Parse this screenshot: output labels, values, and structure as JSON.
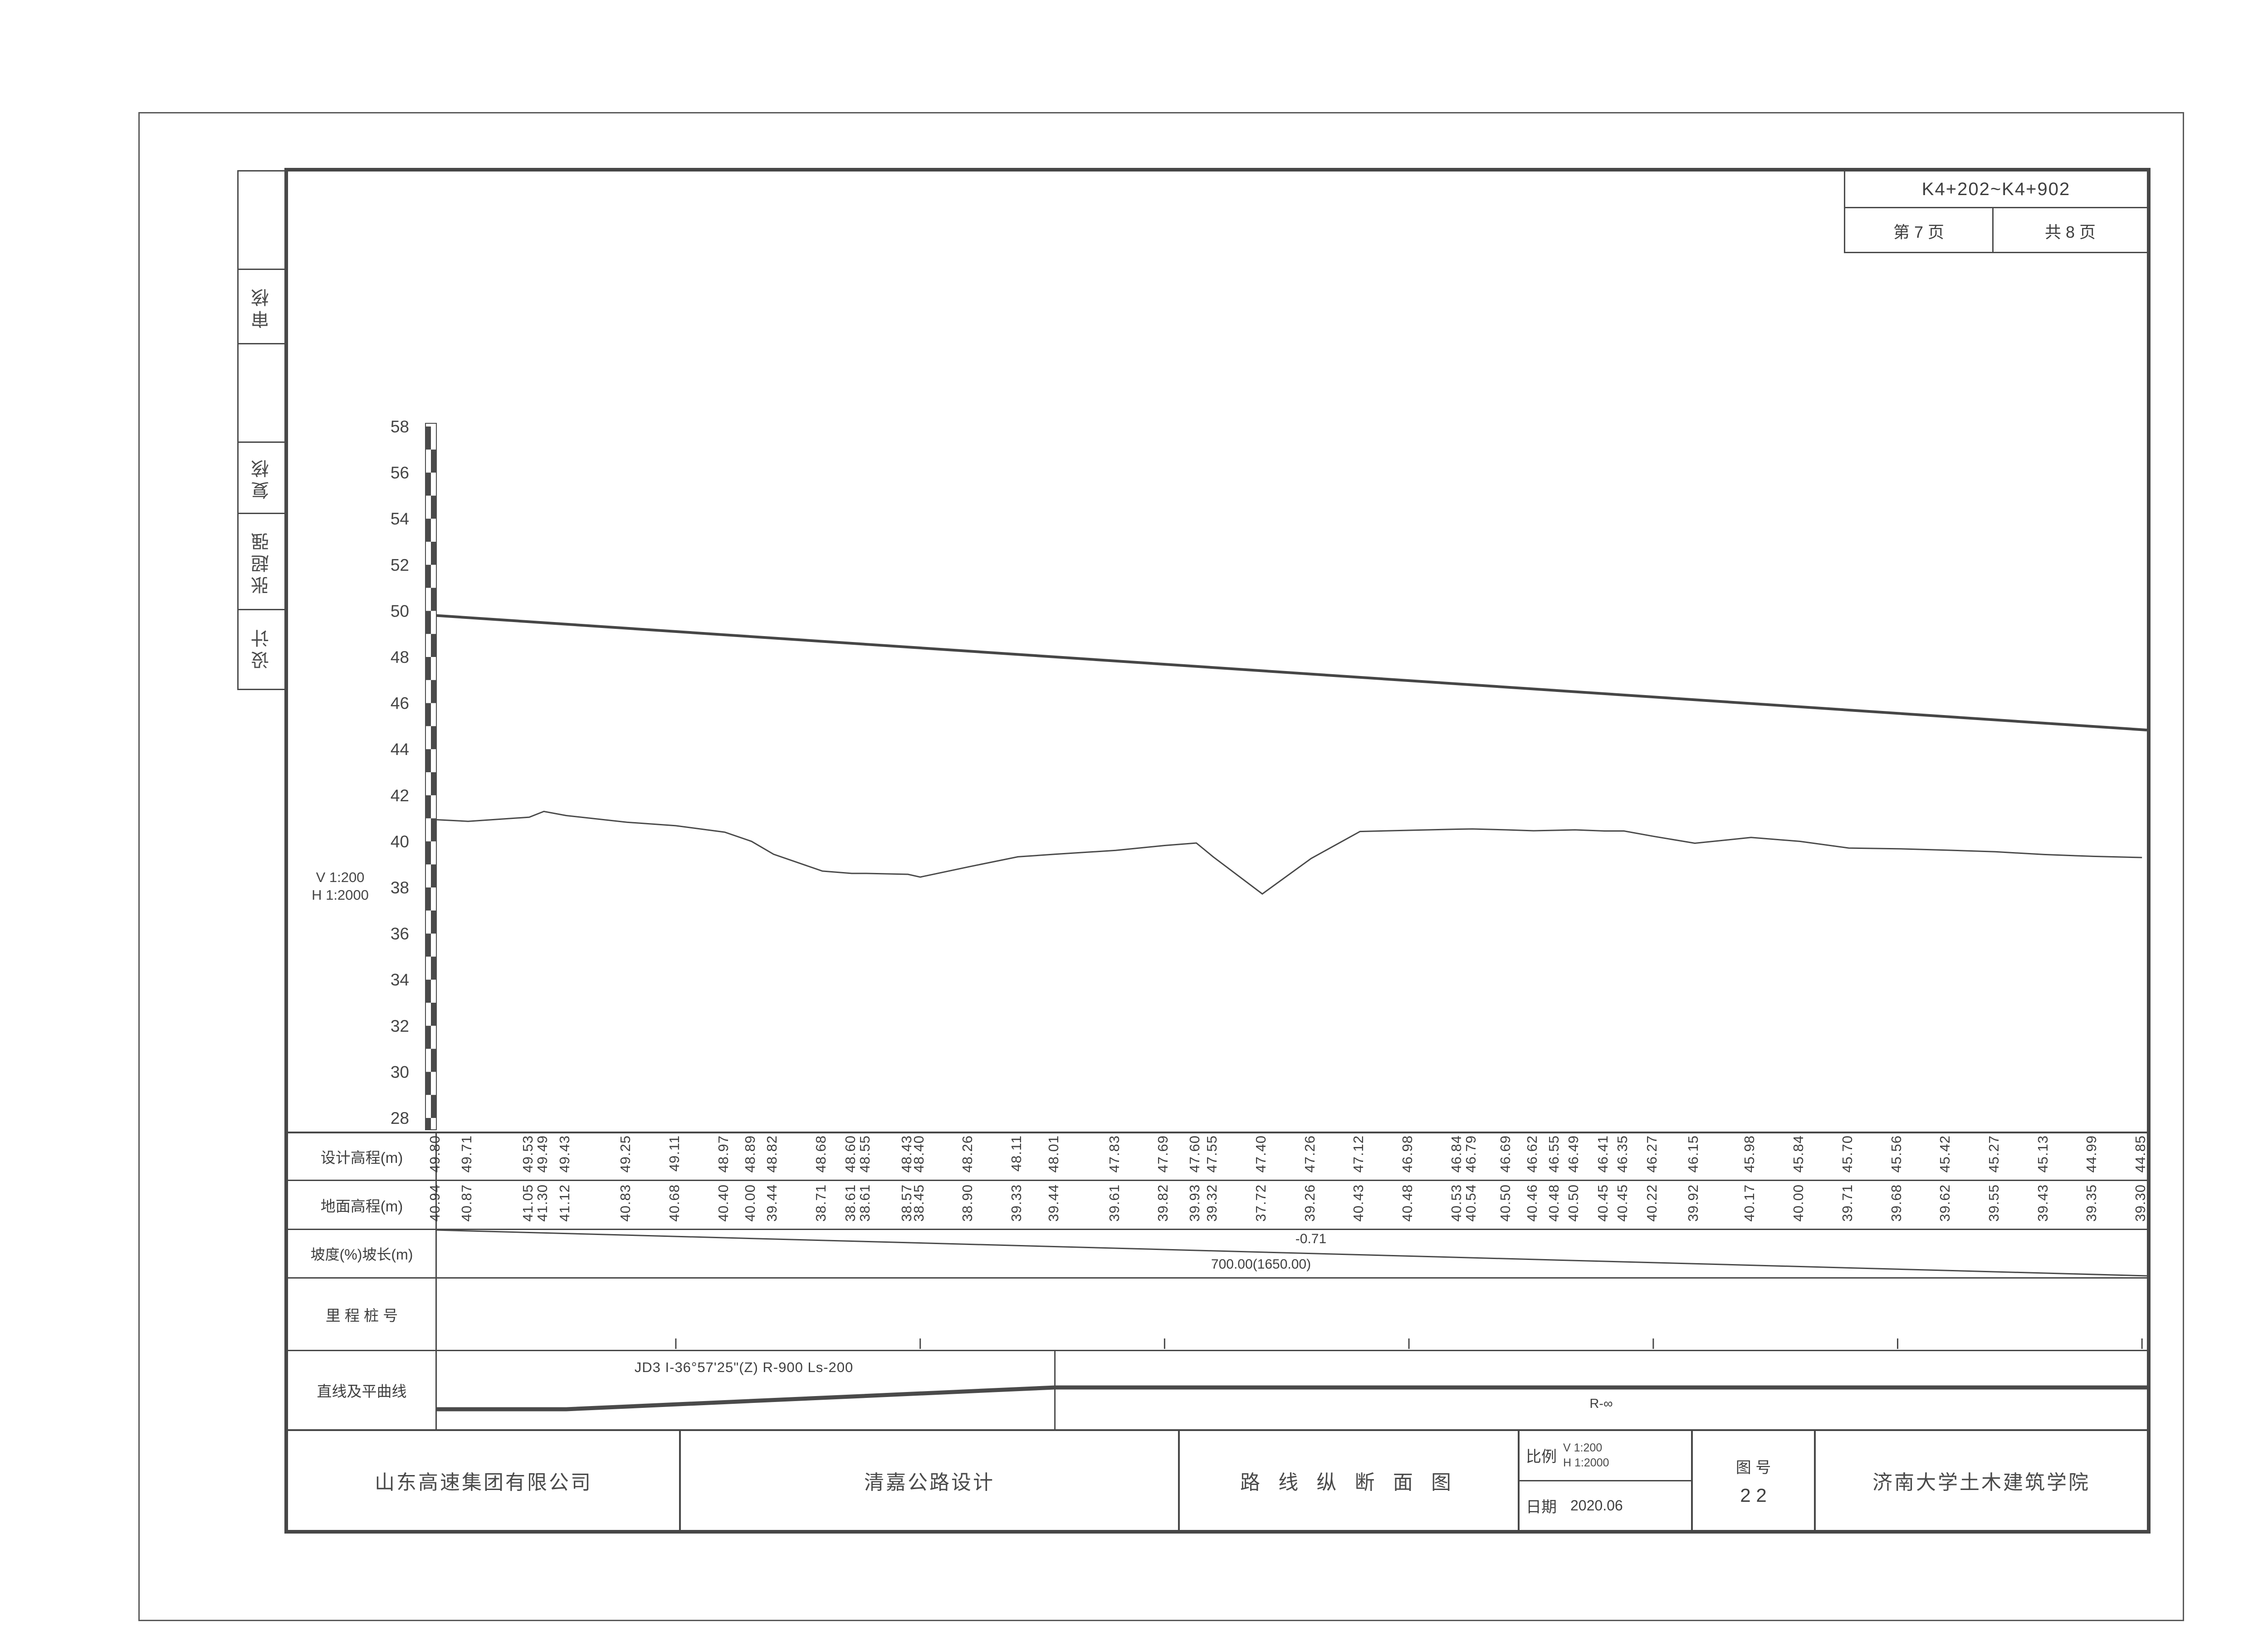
{
  "header": {
    "range": "K4+202~K4+902",
    "page_label": "第  7  页",
    "total_label": "共  8  页"
  },
  "sidebar": {
    "items": [
      {
        "label": ""
      },
      {
        "label": "审核"
      },
      {
        "label": ""
      },
      {
        "label": "复核"
      },
      {
        "label": "张超强"
      },
      {
        "label": "设计"
      }
    ]
  },
  "scale_note": {
    "v": "V 1:200",
    "h": "H 1:2000"
  },
  "axis": {
    "min": 28,
    "max": 58,
    "step": 2,
    "unit": "m"
  },
  "table": {
    "row_labels": [
      "设计高程(m)",
      "地面高程(m)",
      "坡度(%)坡长(m)",
      "里 程 桩 号",
      "直线及平曲线"
    ]
  },
  "slope": {
    "grade": "-0.71",
    "length": "700.00(1650.00)"
  },
  "curve": {
    "left_label": "JD3 I-36°57'25\"(Z) R-900 Ls-200",
    "right_label": "R-∞"
  },
  "title_block": {
    "company": "山东高速集团有限公司",
    "project": "清嘉公路设计",
    "drawing_title": "路 线 纵 断 面 图",
    "scale_label": "比例",
    "scale_v": "V 1:200",
    "scale_h": "H 1:2000",
    "date_label": "日期",
    "date": "2020.06",
    "figure_label": "图  号",
    "figure_number": "2 2",
    "institute": "济南大学土木建筑学院"
  },
  "chart_data": {
    "type": "line",
    "title": "路线纵断面图 K4+202~K4+902",
    "xlabel": "里程桩号",
    "ylabel": "高程(m)",
    "ylim": [
      28,
      58
    ],
    "y_ticks": [
      28,
      30,
      32,
      34,
      36,
      38,
      40,
      42,
      44,
      46,
      48,
      50,
      52,
      54,
      56,
      58
    ],
    "grade_percent": -0.71,
    "grade_length_label": "700.00(1650.00)",
    "series_names": [
      "设计高程",
      "地面高程"
    ],
    "columns": [
      {
        "sta": 202,
        "label": "K4+202",
        "type": "station",
        "design": "49.80",
        "ground": "40.94"
      },
      {
        "sta": 215,
        "label": "+215",
        "type": "station",
        "design": "49.71",
        "ground": "40.87"
      },
      {
        "sta": 240,
        "label": "+240",
        "type": "station",
        "design": "49.53",
        "ground": "41.05"
      },
      {
        "sta": 246,
        "label": "+246",
        "type": "station",
        "design": "49.49",
        "ground": "41.30"
      },
      {
        "sta": 255.126,
        "label": "+255.126",
        "type": "station",
        "design": "49.43",
        "ground": "41.12"
      },
      {
        "sta": 280,
        "label": "+280",
        "type": "station",
        "design": "49.25",
        "ground": "40.83"
      },
      {
        "sta": 300,
        "label": "3",
        "type": "km",
        "design": "49.11",
        "ground": "40.68"
      },
      {
        "sta": 320,
        "label": "+320",
        "type": "station",
        "design": "48.97",
        "ground": "40.40"
      },
      {
        "sta": 331,
        "label": "+331",
        "type": "station",
        "design": "48.89",
        "ground": "40.00"
      },
      {
        "sta": 340,
        "label": "+340",
        "type": "station",
        "design": "48.82",
        "ground": "39.44"
      },
      {
        "sta": 360,
        "label": "+360",
        "type": "station",
        "design": "48.68",
        "ground": "38.71"
      },
      {
        "sta": 372,
        "label": "+372",
        "type": "station",
        "design": "48.60",
        "ground": "38.61"
      },
      {
        "sta": 378,
        "label": "+378",
        "type": "station",
        "design": "48.55",
        "ground": "38.61"
      },
      {
        "sta": 395,
        "label": "+395",
        "type": "station",
        "design": "48.43",
        "ground": "38.57"
      },
      {
        "sta": 400,
        "label": "4",
        "type": "km",
        "design": "48.40",
        "ground": "38.45"
      },
      {
        "sta": 420,
        "label": "+420",
        "type": "station",
        "design": "48.26",
        "ground": "38.90"
      },
      {
        "sta": 440,
        "label": "+440",
        "type": "station",
        "design": "48.11",
        "ground": "39.33"
      },
      {
        "sta": 455.126,
        "label": "+455.126",
        "type": "station",
        "design": "48.01",
        "ground": "39.44"
      },
      {
        "sta": 480,
        "label": "+480",
        "type": "station",
        "design": "47.83",
        "ground": "39.61"
      },
      {
        "sta": 500,
        "label": "5",
        "type": "km",
        "design": "47.69",
        "ground": "39.82"
      },
      {
        "sta": 513,
        "label": "+513",
        "type": "station",
        "design": "47.60",
        "ground": "39.93"
      },
      {
        "sta": 520,
        "label": "+520",
        "type": "station",
        "design": "47.55",
        "ground": "39.32"
      },
      {
        "sta": 540,
        "label": "+540",
        "type": "station",
        "design": "47.40",
        "ground": "37.72"
      },
      {
        "sta": 560,
        "label": "+560",
        "type": "station",
        "design": "47.26",
        "ground": "39.26"
      },
      {
        "sta": 580,
        "label": "+580",
        "type": "station",
        "design": "47.12",
        "ground": "40.43"
      },
      {
        "sta": 600,
        "label": "6",
        "type": "km",
        "design": "46.98",
        "ground": "40.48"
      },
      {
        "sta": 620,
        "label": "+620",
        "type": "station",
        "design": "46.84",
        "ground": "40.53"
      },
      {
        "sta": 626,
        "label": "+626",
        "type": "station",
        "design": "46.79",
        "ground": "40.54"
      },
      {
        "sta": 640,
        "label": "+640",
        "type": "station",
        "design": "46.69",
        "ground": "40.50"
      },
      {
        "sta": 651,
        "label": "+651",
        "type": "station",
        "design": "46.62",
        "ground": "40.46"
      },
      {
        "sta": 660,
        "label": "+660",
        "type": "station",
        "design": "46.55",
        "ground": "40.48"
      },
      {
        "sta": 668,
        "label": "+668",
        "type": "station",
        "design": "46.49",
        "ground": "40.50"
      },
      {
        "sta": 680,
        "label": "+680",
        "type": "station",
        "design": "46.41",
        "ground": "40.45"
      },
      {
        "sta": 688,
        "label": "+688",
        "type": "station",
        "design": "46.35",
        "ground": "40.45"
      },
      {
        "sta": 700,
        "label": "7",
        "type": "km",
        "design": "46.27",
        "ground": "40.22"
      },
      {
        "sta": 717,
        "label": "+717",
        "type": "station",
        "design": "46.15",
        "ground": "39.92"
      },
      {
        "sta": 740,
        "label": "+740",
        "type": "station",
        "design": "45.98",
        "ground": "40.17"
      },
      {
        "sta": 760,
        "label": "+760",
        "type": "station",
        "design": "45.84",
        "ground": "40.00"
      },
      {
        "sta": 780,
        "label": "+780",
        "type": "station",
        "design": "45.70",
        "ground": "39.71"
      },
      {
        "sta": 800,
        "label": "8",
        "type": "km",
        "design": "45.56",
        "ground": "39.68"
      },
      {
        "sta": 820,
        "label": "+820",
        "type": "station",
        "design": "45.42",
        "ground": "39.62"
      },
      {
        "sta": 840,
        "label": "+840",
        "type": "station",
        "design": "45.27",
        "ground": "39.55"
      },
      {
        "sta": 860,
        "label": "+860",
        "type": "station",
        "design": "45.13",
        "ground": "39.43"
      },
      {
        "sta": 880,
        "label": "+880",
        "type": "station",
        "design": "44.99",
        "ground": "39.35"
      },
      {
        "sta": 900,
        "label": "9",
        "type": "km",
        "design": "44.85",
        "ground": "39.30"
      }
    ]
  }
}
